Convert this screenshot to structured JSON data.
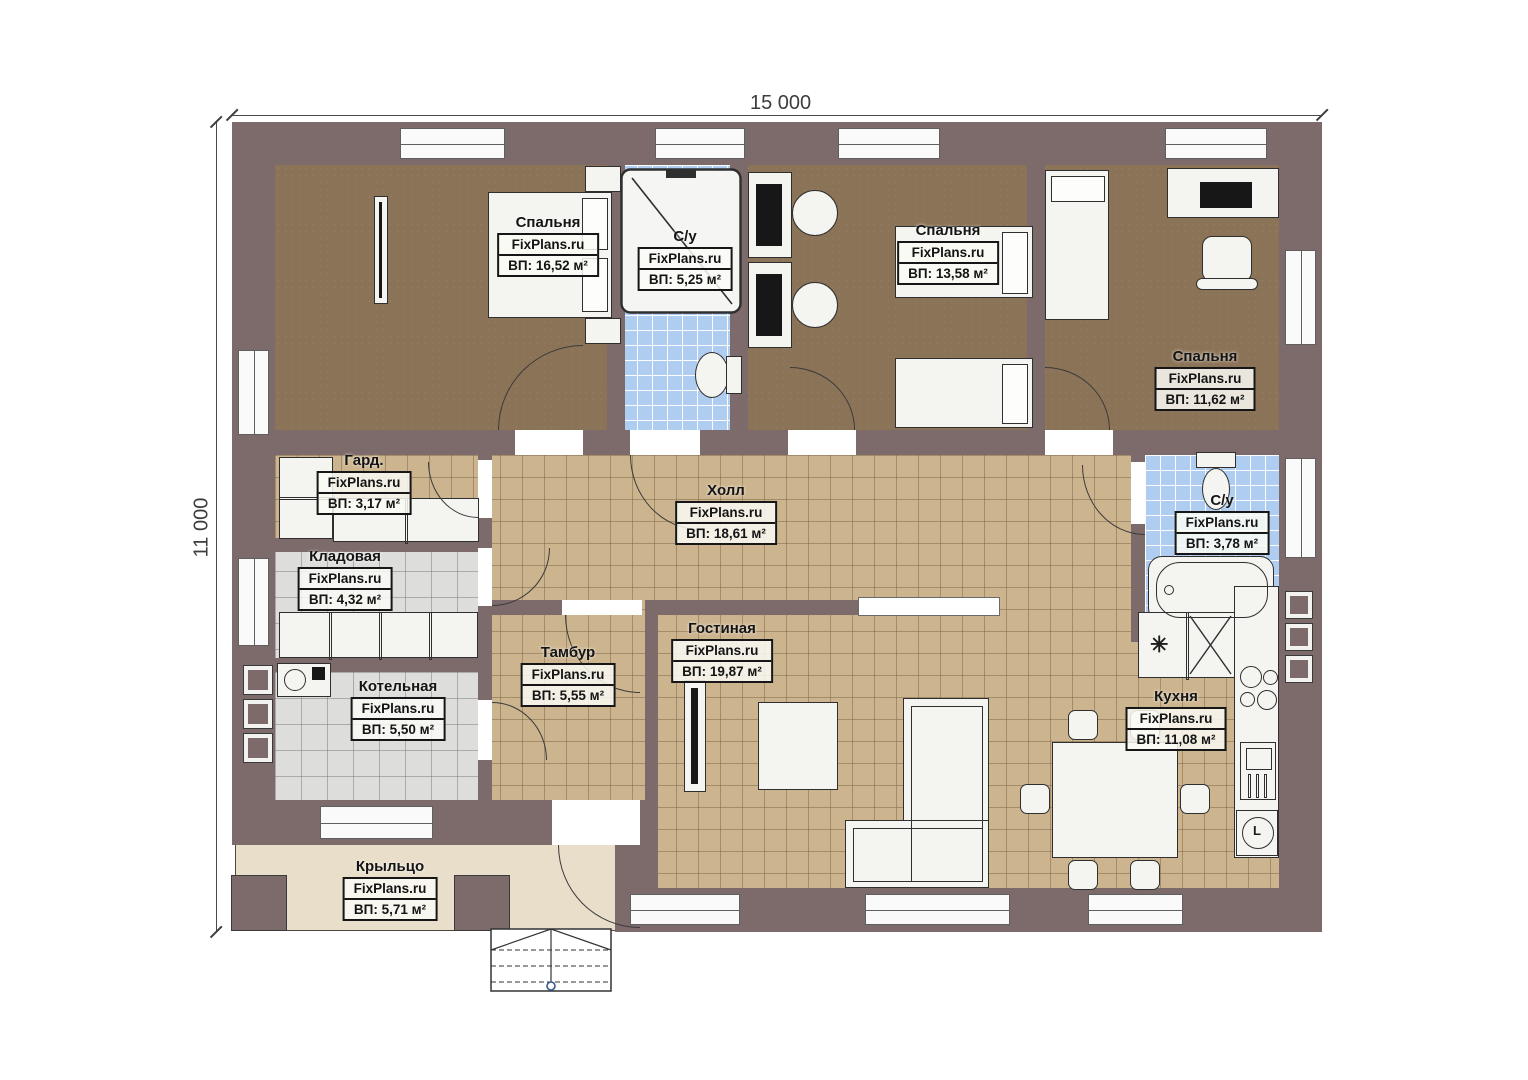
{
  "watermark": "FixPlans.ru",
  "dimensions": {
    "top": "15 000",
    "left": "11 000"
  },
  "rooms": [
    {
      "name": "Спальня",
      "area": "ВП: 16,52 м²"
    },
    {
      "name": "С/у",
      "area": "ВП: 5,25 м²"
    },
    {
      "name": "Спальня",
      "area": "ВП: 13,58 м²"
    },
    {
      "name": "Спальня",
      "area": "ВП: 11,62 м²"
    },
    {
      "name": "Гард.",
      "area": "ВП: 3,17 м²"
    },
    {
      "name": "Холл",
      "area": "ВП: 18,61 м²"
    },
    {
      "name": "С/у",
      "area": "ВП: 3,78 м²"
    },
    {
      "name": "Кладовая",
      "area": "ВП: 4,32 м²"
    },
    {
      "name": "Тамбур",
      "area": "ВП: 5,55 м²"
    },
    {
      "name": "Гостиная",
      "area": "ВП: 19,87 м²"
    },
    {
      "name": "Котельная",
      "area": "ВП: 5,50 м²"
    },
    {
      "name": "Кухня",
      "area": "ВП: 11,08 м²"
    },
    {
      "name": "Крыльцо",
      "area": "ВП: 5,71 м²"
    }
  ],
  "icons": {
    "fridge": "✳",
    "washer": "L"
  },
  "colors": {
    "wall": "#7d6b6b",
    "bedroom_floor": "#8b7357",
    "tile_floor": "#ccb48e",
    "bath_floor": "#aecdf0",
    "utility_floor": "#dddddb",
    "porch_floor": "#e9dec9"
  }
}
